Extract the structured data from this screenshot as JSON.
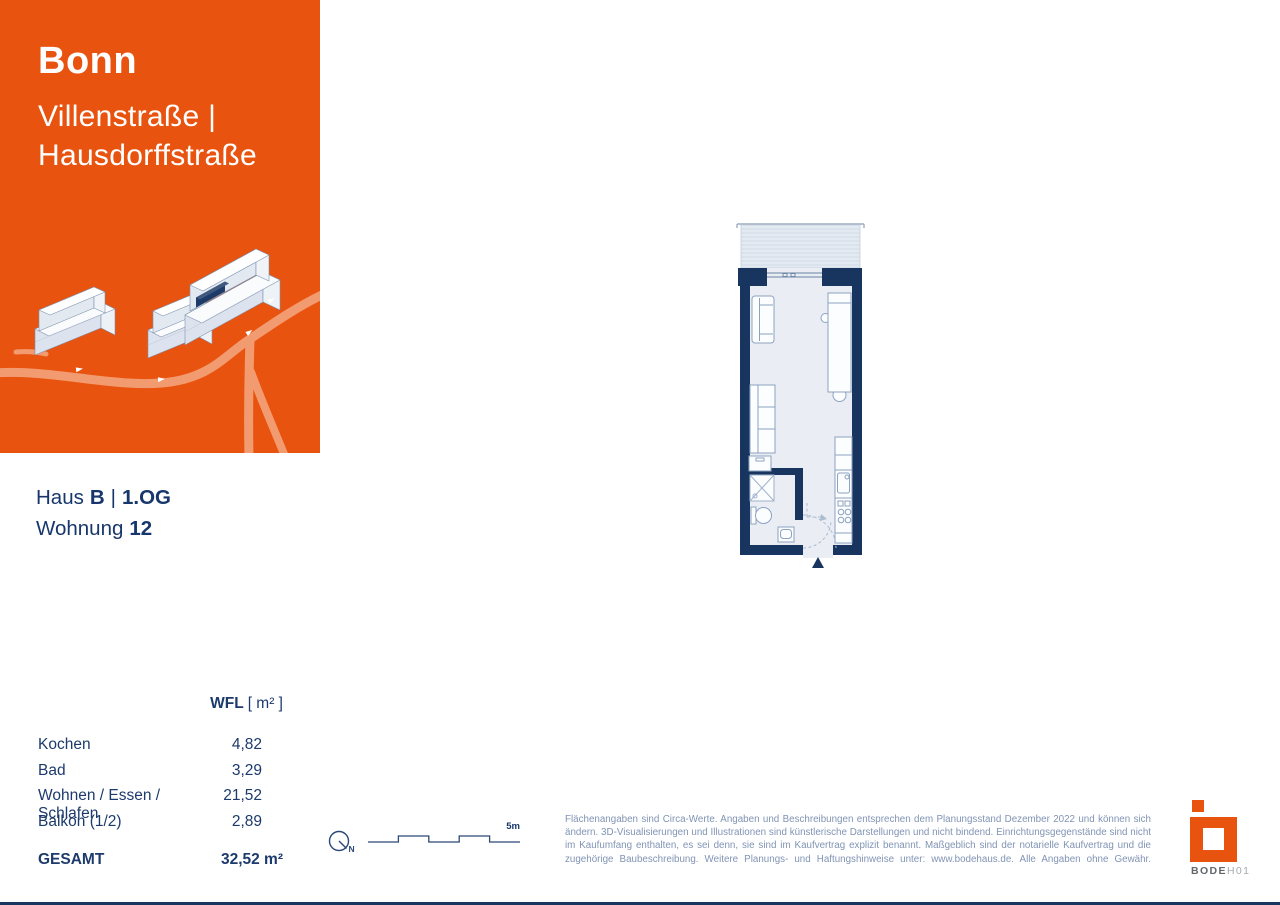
{
  "brand_panel": {
    "city": "Bonn",
    "street_line_1": "Villenstraße |",
    "street_line_2": "Hausdorffstraße"
  },
  "unit_info": {
    "house_label": "Haus",
    "house_value": "B",
    "divider": "|",
    "floor_value": "1.OG",
    "apartment_label": "Wohnung",
    "apartment_number": "12"
  },
  "area_table": {
    "header_metric": "WFL",
    "header_unit": "[ m² ]",
    "rows": [
      {
        "label": "Kochen",
        "value": "4,82"
      },
      {
        "label": "Bad",
        "value": "3,29"
      },
      {
        "label": "Wohnen / Essen / Schlafen",
        "value": "21,52"
      },
      {
        "label": "Balkon (1/2)",
        "value": "2,89"
      }
    ],
    "total_label": "GESAMT",
    "total_value": "32,52 m²"
  },
  "map_aids": {
    "north_label": "N",
    "scale_label": "5m"
  },
  "disclaimer": "Flächenangaben sind Circa-Werte. Angaben und Beschreibungen entsprechen dem Planungsstand Dezember 2022 und können sich ändern. 3D-Visualisierungen und Illustrationen sind künstlerische Darstellungen und nicht bindend. Einrichtungsgegenstände sind nicht im Kaufumfang enthalten, es sei denn, sie sind im Kaufvertrag explizit benannt. Maßgeblich sind der notarielle Kaufvertrag und die zugehörige Baubeschreibung. Weitere Planungs- und Haftungshinweise unter: www.bodehaus.de. Alle Angaben ohne Gewähr.",
  "logo": {
    "text_strong": "BODE",
    "text_light": "H01"
  },
  "colors": {
    "accent_orange": "#E8530F",
    "road_orange": "#F39B70",
    "heading_navy": "#17376C",
    "wall_navy": "#17355E",
    "plan_fill": "#EAEEF4",
    "muted_blue_text": "#8194B4"
  }
}
